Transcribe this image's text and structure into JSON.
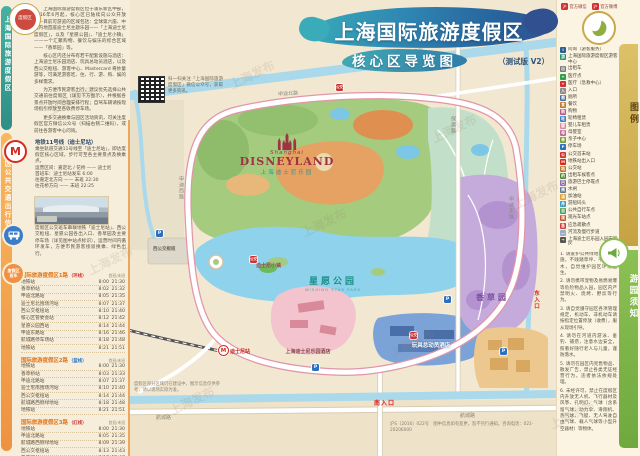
{
  "watermark": "上海发布",
  "header": {
    "title": "上海国际旅游度假区",
    "subtitle": "核心区导览图",
    "version_note": "（测试版 V2）"
  },
  "sidebar_left": {
    "strip_top": "上海国际旅游度假区",
    "strip_bottom": "度假区公共交通出行信息",
    "badge": "度假区",
    "intro_paragraphs": [
      "上海国际旅游度假区位于浦东新区中部，2016年6月起，核心区已陆续向公众开放——目前可游览的区域包括：全球第六座、中国内地首座迪士尼主题乐园——「上海迪士尼度假区」，以及「星愿公园」、「迪士尼小镇」——一个汇聚购物、餐饮与娱乐的综合区域——「香草园」等。",
      "核心区内还分布有若干配套设施与酒店：上海迪士尼乐园酒店、玩具总动员酒店，以及西公交枢纽、游客中心、Mastercard 奇妙童游等，可满足游客吃、住、行、游、购、娱的多样需求。",
      "为方便市民游客出行，建议优先选择公共交通前往度假区（详见下方图示），并根据各景点开放时间合理安排行程；自驾车辆请按现场指引停放至各收费停车场。",
      "更多交通换乘与园区活动资讯，可关注度假区官方微信公众号（扫描右侧二维码），或前往各游客中心问询。"
    ],
    "metro": {
      "title": "地铁11号线（迪士尼站）",
      "lines": [
        "乘坐轨道交通11号线至「迪士尼站」，即达度假区核心区域，步行可至各主要景点及换乘点。",
        "运营区间：嘉定北 / 花桥 —— 迪士尼",
        "首班车：迪士尼站发车 6:00",
        "往嘉定北方向 —— 末班 22:30",
        "往花桥方向 —— 末班 22:25"
      ]
    },
    "bus": {
      "text": "度假区公交班车串联地铁「迪士尼站」、西公交枢纽、星愿公园各出入口、香草园及主要停车场（详见图中站点标识），运营时间内循环发车，方便市民游客接驳换乘、绿色出行。"
    },
    "shuttles": [
      {
        "title": "国际旅游度假区1路",
        "tag": "（环线）",
        "tag_color": "#d03030",
        "col_first": "首班",
        "col_last": "末班",
        "stops": [
          {
            "name": "地铁站",
            "first": "8:00",
            "last": "21:30"
          },
          {
            "name": "香草桥站",
            "first": "8:02",
            "last": "21:32"
          },
          {
            "name": "申迪北路站",
            "first": "8:05",
            "last": "21:35"
          },
          {
            "name": "迪士尼北围场河站",
            "first": "8:07",
            "last": "21:37"
          },
          {
            "name": "西公交枢纽站",
            "first": "8:10",
            "last": "21:40"
          },
          {
            "name": "核心区管委会站",
            "first": "8:12",
            "last": "21:42"
          },
          {
            "name": "星愿公园西站",
            "first": "8:14",
            "last": "21:44"
          },
          {
            "name": "申迪东路站",
            "first": "8:16",
            "last": "21:46"
          },
          {
            "name": "航城路停车场站",
            "first": "8:18",
            "last": "21:48"
          },
          {
            "name": "地铁站",
            "first": "8:21",
            "last": "21:51"
          }
        ]
      },
      {
        "title": "国际旅游度假区2路",
        "tag": "（蓝线）",
        "tag_color": "#2a6fc0",
        "col_first": "首班",
        "col_last": "末班",
        "stops": [
          {
            "name": "地铁站",
            "first": "8:00",
            "last": "21:30"
          },
          {
            "name": "香草桥站",
            "first": "8:03",
            "last": "21:33"
          },
          {
            "name": "申迪北路站",
            "first": "8:07",
            "last": "21:37"
          },
          {
            "name": "迪士尼南围场河站",
            "first": "8:10",
            "last": "21:40"
          },
          {
            "name": "西公交枢纽站",
            "first": "8:14",
            "last": "21:44"
          },
          {
            "name": "航城路西侧绿地站",
            "first": "8:18",
            "last": "21:48"
          },
          {
            "name": "地铁站",
            "first": "8:21",
            "last": "21:51"
          }
        ]
      },
      {
        "title": "国际旅游度假区3路",
        "tag": "（红线）",
        "tag_color": "#d03030",
        "col_first": "首班",
        "col_last": "末班",
        "stops": [
          {
            "name": "地铁站",
            "first": "8:00",
            "last": "21:30"
          },
          {
            "name": "申迪北路站",
            "first": "8:05",
            "last": "21:35"
          },
          {
            "name": "航城路西侧绿地站",
            "first": "8:09",
            "last": "21:39"
          },
          {
            "name": "西公交枢纽站",
            "first": "8:13",
            "last": "21:43"
          },
          {
            "name": "香草桥站",
            "first": "8:16",
            "last": "21:46"
          },
          {
            "name": "星愿湖码头站",
            "first": "8:19",
            "last": "21:49"
          },
          {
            "name": "地铁站",
            "first": "8:24",
            "last": "21:54"
          }
        ]
      }
    ]
  },
  "map": {
    "qr_caption": "扫一扫关注「上海国际旅游度假区」微信公众号，获取更多资讯。",
    "disneyland": {
      "pre": "Shanghai",
      "name": "DISNEYLAND",
      "cn": "上海迪士尼乐园"
    },
    "labels": {
      "wishing_park": "星愿公园",
      "wishing_park_en": "WISHING STAR PARK",
      "herb_garden": "香草园",
      "disneyland_hotel": "上海迪士尼乐园酒店",
      "toy_story_hotel": "玩具总动员酒店",
      "disney_town": "迪士尼小镇",
      "west_hub": "西公交枢纽",
      "metro_station": "迪士尼站",
      "south_entrance": "南入口",
      "east_entrance": "东入口",
      "p_glyph": "P",
      "bus_glyph": "公交",
      "metro_glyph": "M"
    },
    "roads": {
      "shendi_north": "申迪北路",
      "shendi_west": "申迪西路",
      "shendi_east": "申迪东路",
      "hangcheng_w": "航城路",
      "hangcheng_e": "航城路",
      "tansuo": "探索路",
      "river_top": "赵家沟"
    },
    "notes": {
      "bottom_left": "度假区部分区域仍在建设中，图示信息仅供参考，请以现场实际为准。",
      "bottom_right": "沪S（2016）022号　图中信息如有变更，恕不另行通知。咨询电话：021-20206000"
    }
  },
  "sidebar_right": {
    "badges": [
      {
        "label": "官方微信"
      },
      {
        "label": "官方微博"
      }
    ],
    "legend_tab": "图例",
    "legend": [
      {
        "glyph": "i",
        "color": "#2b5f8f",
        "label": "问询（游客服务）"
      },
      {
        "glyph": "游",
        "color": "#2b8f6f",
        "label": "上海国际旅游度假区游客中心"
      },
      {
        "glyph": "出",
        "color": "#777777",
        "label": "出租车"
      },
      {
        "glyph": "+",
        "color": "#2e9e4f",
        "label": "医疗点"
      },
      {
        "glyph": "+",
        "color": "#d03030",
        "label": "医疗（急救中心）"
      },
      {
        "glyph": "入",
        "color": "#8a8a8a",
        "label": "入口"
      },
      {
        "glyph": "厕",
        "color": "#4a6fa0",
        "label": "厕所"
      },
      {
        "glyph": "食",
        "color": "#c07a30",
        "label": "餐饮"
      },
      {
        "glyph": "购",
        "color": "#b05a8a",
        "label": "购物"
      },
      {
        "glyph": "轮",
        "color": "#3a7cc8",
        "label": "轮椅租赁"
      },
      {
        "glyph": "婴",
        "color": "#d88aa0",
        "label": "婴儿车租赁"
      },
      {
        "glyph": "母",
        "color": "#c06a9a",
        "label": "母婴室"
      },
      {
        "glyph": "亲",
        "color": "#7a9a3a",
        "label": "亲子中心"
      },
      {
        "glyph": "P",
        "color": "#2a6fc0",
        "label": "停车场"
      },
      {
        "glyph": "公",
        "color": "#d03030",
        "label": "公交首末站"
      },
      {
        "glyph": "M",
        "color": "#d42a20",
        "label": "地铁站出入口"
      },
      {
        "glyph": "站",
        "color": "#c07830",
        "label": "公交站"
      },
      {
        "glyph": "的",
        "color": "#4a8a3a",
        "label": "出租车候客点"
      },
      {
        "glyph": "巴",
        "color": "#8a6ab0",
        "label": "旅游巴士停靠点"
      },
      {
        "glyph": "闸",
        "color": "#5a7a9a",
        "label": "水闸"
      },
      {
        "glyph": "油",
        "color": "#e0a030",
        "label": "加油站"
      },
      {
        "glyph": "舟",
        "color": "#3a9ac0",
        "label": "游船码头"
      },
      {
        "glyph": "自",
        "color": "#4aa05a",
        "label": "公共自行车点"
      },
      {
        "glyph": "观",
        "color": "#c05a3a",
        "label": "观光车站点"
      },
      {
        "glyph": "急",
        "color": "#d04040",
        "label": "应急疏散点"
      },
      {
        "glyph": "—",
        "color": "#9ab0c8",
        "label": "河流及慢行步道"
      },
      {
        "glyph": "→",
        "color": "#555555",
        "label": "上海迪士尼乐园入园安检区"
      }
    ],
    "notice_tab": "游园须知",
    "notices": [
      "1. 请爱护公共绿地和公共设施，不践踏草坪、不攀折花木，自觉维护园区环境卫生。",
      "2. 请勿携带宠物及易燃易爆等危险物品入园，园区内严禁明火、烧烤、野炊等行为。",
      "3. 请自觉遵守园区各项管理规定，机动车、非机动车请按指定位置停放（收费），服从现场引导。",
      "4. 请勿在河道内游泳、垂钓、捕捞，注意水边安全，照看好随行老人与儿童，谨防落水。",
      "5. 请勿在园区内兜售物品、散发广告，禁止各类无证经营行为，违者依法依规处理。",
      "6. 未经许可，禁止在度假区内升放无人机、飞行器材及风筝、孔明灯、气球（含系留气球、动力伞、滑翔机、热气球、飞艇、无人驾驶自由气球、载人气球等小型升空器材）等物体。"
    ]
  }
}
